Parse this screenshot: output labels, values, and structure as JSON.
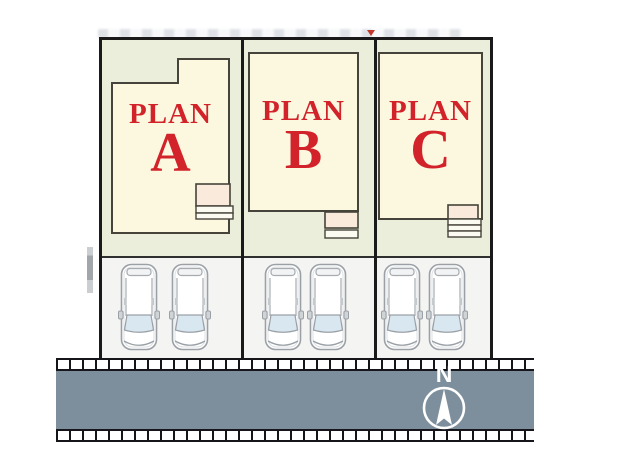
{
  "diagram": {
    "type": "residential-site-plan",
    "lots": [
      {
        "plan_word": "PLAN",
        "plan_letter": "A"
      },
      {
        "plan_word": "PLAN",
        "plan_letter": "B"
      },
      {
        "plan_word": "PLAN",
        "plan_letter": "C"
      }
    ],
    "parking": {
      "cars_per_lot": 2
    },
    "compass": {
      "north_label": "N"
    },
    "colors": {
      "lot_yard": "#EAEEDA",
      "building_fill": "#FCF8DF",
      "building_stroke": "#45433A",
      "porch_fill": "#F9EADC",
      "label_red": "#D2222A",
      "road_fill": "#7D8F9C",
      "parking_fill": "#F4F4F2",
      "border_black": "#1A1A1A",
      "compass_white": "#FFFFFF",
      "windshield_blue": "#D9E7F0"
    }
  }
}
